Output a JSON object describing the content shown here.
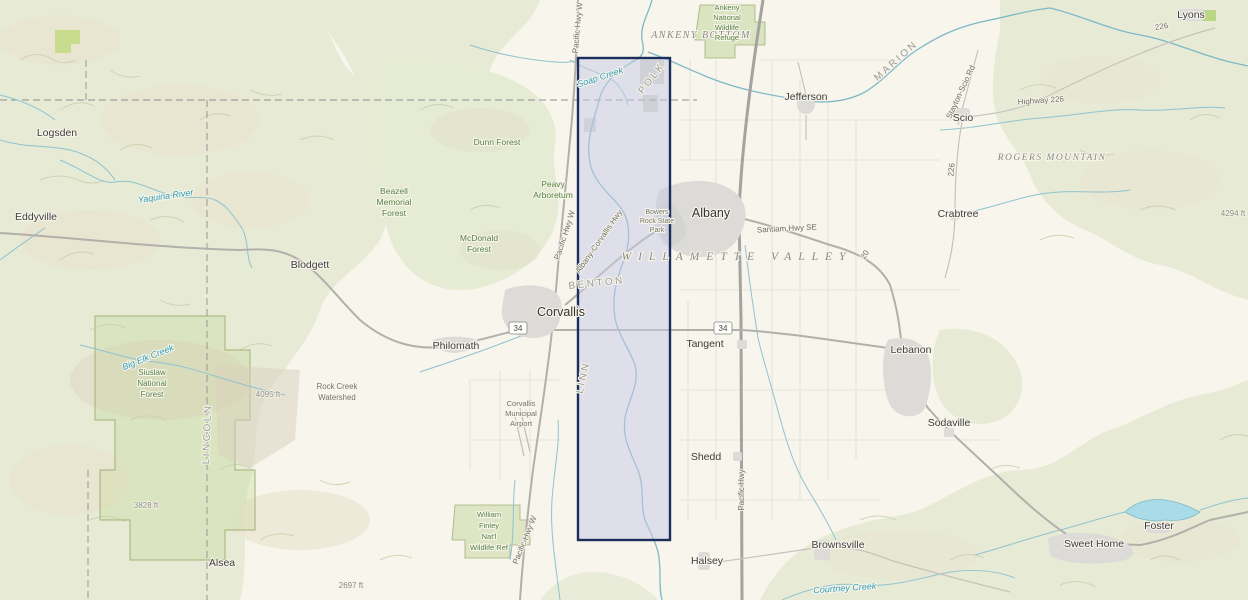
{
  "map": {
    "description": "Topographic basemap of the Willamette Valley, Oregon with a highlighted selection extent",
    "selection": {
      "x": 578,
      "y": 58,
      "width": 92,
      "height": 482,
      "fill": "rgba(200,202,230,0.5)",
      "stroke": "#1c2e5c"
    },
    "colors": {
      "valley": "#f7f5ec",
      "hills": "#e7ebd6",
      "water": "#7db9c6",
      "selection_border": "#1c2e5c",
      "forest_label": "#55813f"
    },
    "labels": {
      "cities": [
        {
          "t": "Logsden",
          "x": 57,
          "y": 136
        },
        {
          "t": "Eddyville",
          "x": 36,
          "y": 220
        },
        {
          "t": "Blodgett",
          "x": 310,
          "y": 268
        },
        {
          "t": "Alsea",
          "x": 222,
          "y": 566
        },
        {
          "t": "Philomath",
          "x": 456,
          "y": 349
        },
        {
          "t": "Corvallis",
          "x": 561,
          "y": 316,
          "big": true
        },
        {
          "t": "Albany",
          "x": 711,
          "y": 217,
          "big": true
        },
        {
          "t": "Jefferson",
          "x": 806,
          "y": 100
        },
        {
          "t": "Scio",
          "x": 963,
          "y": 121
        },
        {
          "t": "Lyons",
          "x": 1191,
          "y": 18
        },
        {
          "t": "Crabtree",
          "x": 958,
          "y": 217
        },
        {
          "t": "Tangent",
          "x": 705,
          "y": 347
        },
        {
          "t": "Lebanon",
          "x": 911,
          "y": 353
        },
        {
          "t": "Sodaville",
          "x": 949,
          "y": 426
        },
        {
          "t": "Shedd",
          "x": 706,
          "y": 460
        },
        {
          "t": "Halsey",
          "x": 707,
          "y": 564
        },
        {
          "t": "Brownsville",
          "x": 838,
          "y": 548
        },
        {
          "t": "Sweet Home",
          "x": 1094,
          "y": 547
        },
        {
          "t": "Foster",
          "x": 1159,
          "y": 529
        }
      ],
      "areas": [
        {
          "t": "ANKENY BOTTOM",
          "x": 701,
          "y": 38
        },
        {
          "t": "WILLAMETTE VALLEY",
          "x": 737,
          "y": 260,
          "ls": 7,
          "fs": 11.5
        },
        {
          "t": "ROGERS MOUNTAIN",
          "x": 1052,
          "y": 160,
          "fs": 9.5
        }
      ],
      "forests": [
        {
          "t": "Ankeny",
          "x": 727,
          "y": 10,
          "fs": 7.5
        },
        {
          "t": "National",
          "x": 727,
          "y": 20,
          "fs": 7.5
        },
        {
          "t": "Wildlife",
          "x": 727,
          "y": 30,
          "fs": 7.5
        },
        {
          "t": "Refuge",
          "x": 727,
          "y": 40,
          "fs": 7.5
        },
        {
          "t": "Dunn Forest",
          "x": 497,
          "y": 145
        },
        {
          "t": "Peavy",
          "x": 553,
          "y": 187
        },
        {
          "t": "Arboretum",
          "x": 553,
          "y": 198
        },
        {
          "t": "Beazell",
          "x": 394,
          "y": 194
        },
        {
          "t": "Memorial",
          "x": 394,
          "y": 205
        },
        {
          "t": "Forest",
          "x": 394,
          "y": 216
        },
        {
          "t": "McDonald",
          "x": 479,
          "y": 241
        },
        {
          "t": "Forest",
          "x": 479,
          "y": 252
        },
        {
          "t": "William",
          "x": 489,
          "y": 517,
          "fs": 7.5
        },
        {
          "t": "Finley",
          "x": 489,
          "y": 528,
          "fs": 7.5
        },
        {
          "t": "Nat'l",
          "x": 489,
          "y": 539,
          "fs": 7.5
        },
        {
          "t": "Wildlife Ref",
          "x": 489,
          "y": 550,
          "fs": 7.5
        },
        {
          "t": "Siuslaw",
          "x": 152,
          "y": 375,
          "fs": 8
        },
        {
          "t": "National",
          "x": 152,
          "y": 386,
          "fs": 8
        },
        {
          "t": "Forest",
          "x": 152,
          "y": 397,
          "fs": 8
        }
      ],
      "places": [
        {
          "t": "Rock Creek",
          "x": 337,
          "y": 389
        },
        {
          "t": "Watershed",
          "x": 337,
          "y": 400
        },
        {
          "t": "Bowers",
          "x": 657,
          "y": 214,
          "fs": 7
        },
        {
          "t": "Rock State",
          "x": 657,
          "y": 223,
          "fs": 7
        },
        {
          "t": "Park",
          "x": 657,
          "y": 232,
          "fs": 7
        },
        {
          "t": "Corvallis",
          "x": 521,
          "y": 406,
          "fs": 7.5
        },
        {
          "t": "Municipal",
          "x": 521,
          "y": 416,
          "fs": 7.5
        },
        {
          "t": "Airport",
          "x": 521,
          "y": 426,
          "fs": 7.5
        }
      ],
      "counties": [
        {
          "t": "POLK",
          "x": 654,
          "y": 80,
          "r": -52
        },
        {
          "t": "MARION",
          "x": 898,
          "y": 63,
          "r": -42
        },
        {
          "t": "BENTON",
          "x": 597,
          "y": 286,
          "r": -6
        },
        {
          "t": "LINN",
          "x": 586,
          "y": 378,
          "r": -78
        },
        {
          "t": "LINCOLN",
          "x": 210,
          "y": 434,
          "r": -88
        }
      ],
      "water": [
        {
          "t": "Yaquina River",
          "x": 166,
          "y": 199,
          "r": -8
        },
        {
          "t": "Soap Creek",
          "x": 601,
          "y": 80,
          "r": -18
        },
        {
          "t": "Big Elk Creek",
          "x": 149,
          "y": 360,
          "r": -22
        },
        {
          "t": "Courtney Creek",
          "x": 845,
          "y": 591,
          "r": -4
        }
      ],
      "roads": [
        {
          "t": "Pacific Hwy W",
          "x": 567,
          "y": 236,
          "r": -72
        },
        {
          "t": "Albany-Corvallis Hwy",
          "x": 601,
          "y": 243,
          "r": -55
        },
        {
          "t": "Pacific Hwy W",
          "x": 580,
          "y": 28,
          "r": -85
        },
        {
          "t": "Pacific Hwy W",
          "x": 527,
          "y": 541,
          "r": -68
        },
        {
          "t": "Pacific Hwy",
          "x": 744,
          "y": 490,
          "r": -90
        },
        {
          "t": "Santiam Hwy SE",
          "x": 787,
          "y": 231,
          "r": -3
        },
        {
          "t": "Highway 226",
          "x": 1041,
          "y": 103,
          "r": -4
        },
        {
          "t": "Stayton-Scio Rd",
          "x": 963,
          "y": 93,
          "r": -65
        },
        {
          "t": "226",
          "x": 1162,
          "y": 29,
          "r": -10
        },
        {
          "t": "226",
          "x": 954,
          "y": 170,
          "r": -85
        },
        {
          "t": "20",
          "x": 867,
          "y": 256,
          "r": -60
        }
      ],
      "elev": [
        {
          "t": "4095 ft",
          "x": 268,
          "y": 397
        },
        {
          "t": "3828 ft",
          "x": 146,
          "y": 508
        },
        {
          "t": "2697 ft",
          "x": 351,
          "y": 588
        },
        {
          "t": "4294 ft",
          "x": 1233,
          "y": 216
        }
      ],
      "shields": [
        {
          "t": "34",
          "x": 518,
          "y": 330
        },
        {
          "t": "34",
          "x": 723,
          "y": 330
        }
      ]
    }
  }
}
